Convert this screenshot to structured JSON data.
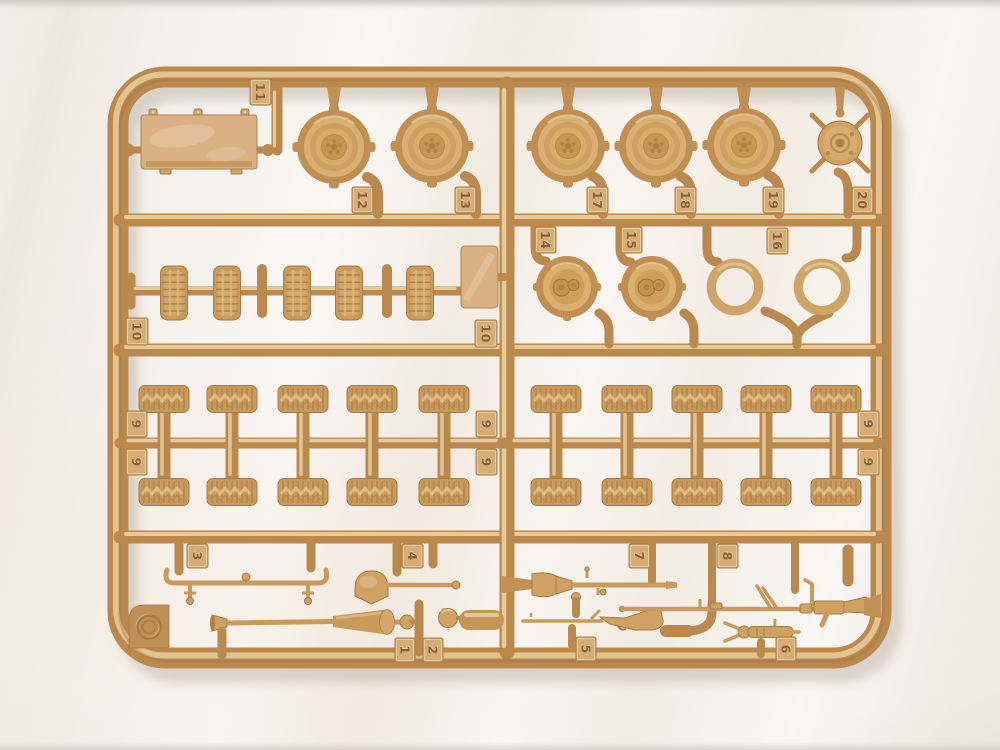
{
  "photo": {
    "subject": "tan plastic model kit sprue with numbered wheel, tire and weapon parts",
    "corner_mark": "embossed double circle"
  },
  "colors": {
    "background": "#f3efe9",
    "plastic_base": "#bb894d",
    "plastic_highlight": "#efd6a6",
    "plastic_shadow": "#a67a42",
    "part_fill": "#cfa263",
    "part_light": "#d9b183",
    "tag_fill": "#d6ad77",
    "tag_text": "#8a5e2f"
  },
  "tags": [
    {
      "label": "11"
    },
    {
      "label": "12"
    },
    {
      "label": "13"
    },
    {
      "label": "17"
    },
    {
      "label": "18"
    },
    {
      "label": "19"
    },
    {
      "label": "20"
    },
    {
      "label": "14"
    },
    {
      "label": "15"
    },
    {
      "label": "16"
    },
    {
      "label": "10"
    },
    {
      "label": "10"
    },
    {
      "label": "9"
    },
    {
      "label": "9"
    },
    {
      "label": "9"
    },
    {
      "label": "9"
    },
    {
      "label": "9"
    },
    {
      "label": "9"
    },
    {
      "label": "3"
    },
    {
      "label": "4"
    },
    {
      "label": "7"
    },
    {
      "label": "8"
    },
    {
      "label": "1"
    },
    {
      "label": "2"
    },
    {
      "label": "5"
    },
    {
      "label": "6"
    }
  ]
}
